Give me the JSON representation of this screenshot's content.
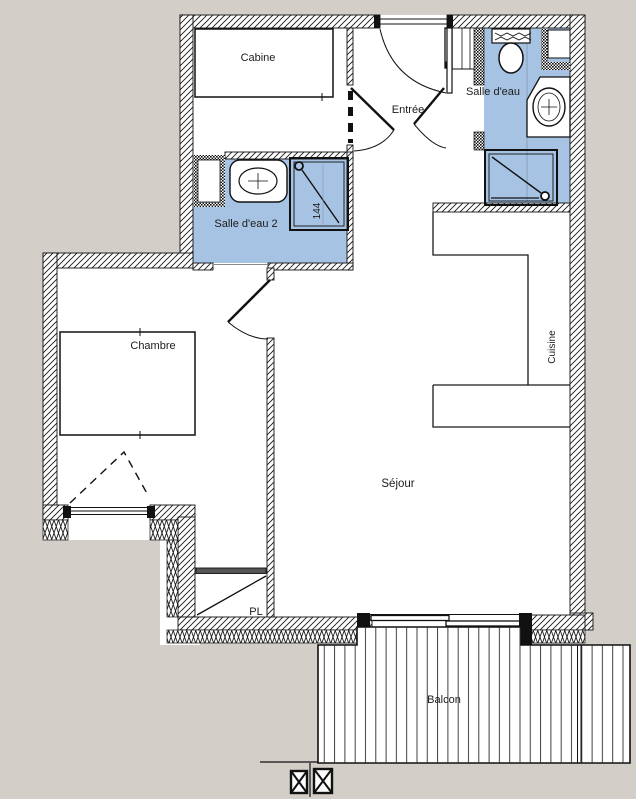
{
  "document": {
    "type": "apartment-floor-plan",
    "background_color": "#d3cfc8",
    "wet_room_floor_color": "#a7c3e4",
    "wall_line_color": "#1a1a1a",
    "label_text_color": "#1c1c1c"
  },
  "labels": {
    "cabine": "Cabine",
    "entree": "Entrée",
    "salle_deau": "Salle d'eau",
    "salle_deau_2": "Salle d'eau 2",
    "shower_dim": "144",
    "chambre": "Chambre",
    "cuisine": "Cuisine",
    "sejour": "Séjour",
    "placard": "PL",
    "balcon": "Balcon"
  },
  "rooms": [
    {
      "name": "Cabine",
      "zone": "top-left sleeping cabin with bed"
    },
    {
      "name": "Entrée",
      "zone": "top-center entry hall with front door"
    },
    {
      "name": "Salle d'eau",
      "zone": "top-right shower room: washer, WC, basin, shower"
    },
    {
      "name": "Salle d'eau 2",
      "zone": "mid-left shower room: basin, shower 144"
    },
    {
      "name": "Chambre",
      "zone": "left bedroom with bed and French window"
    },
    {
      "name": "Cuisine",
      "zone": "right kitchen alcove with L counter"
    },
    {
      "name": "Séjour",
      "zone": "main living room"
    },
    {
      "name": "PL",
      "zone": "closet under stair of wall"
    },
    {
      "name": "Balcon",
      "zone": "bottom decked balcony with sliding bay"
    }
  ]
}
